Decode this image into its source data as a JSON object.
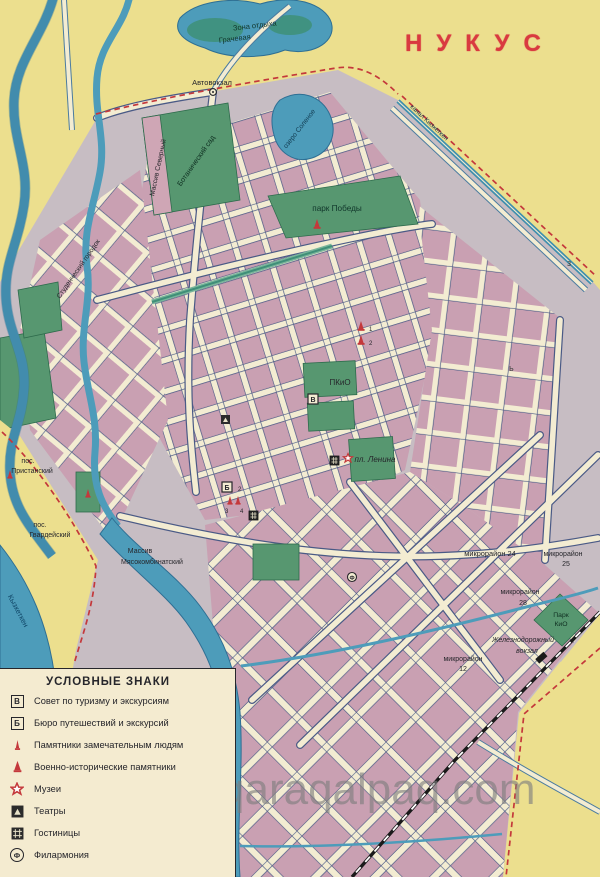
{
  "title": "НУКУС",
  "watermark": "qaraqalpaq.com",
  "colors": {
    "title_red": "#d93a40",
    "background_yellow": "#ecdf8e",
    "city_grey": "#c7bdc3",
    "block_pink": "#c9a0b2",
    "street_cream": "#f3ecd2",
    "water_blue": "#4d9cba",
    "park_green": "#579770",
    "boundary_red_dash": "#c4383b",
    "railway_black": "#1a1a1a",
    "legend_cream": "#f4ebd0",
    "watermark_grey": "#7e7e7e"
  },
  "legend": {
    "title": "УСЛОВНЫЕ ЗНАКИ",
    "items": [
      {
        "id": "tourism-council",
        "glyph": "В",
        "label": "Совет по туризму и экскурсиям"
      },
      {
        "id": "travel-bureau",
        "glyph": "Б",
        "label": "Бюро путешествий и экскурсий"
      },
      {
        "id": "monuments-people",
        "glyph": "",
        "label": "Памятники замечательным людям"
      },
      {
        "id": "war-monuments",
        "glyph": "",
        "label": "Военно-исторические памятники"
      },
      {
        "id": "museums",
        "glyph": "",
        "label": "Музеи"
      },
      {
        "id": "theatres",
        "glyph": "",
        "label": "Театры"
      },
      {
        "id": "hotels",
        "glyph": "",
        "label": "Гостиницы"
      },
      {
        "id": "philharmonic",
        "glyph": "Ф",
        "label": "Филармония"
      }
    ]
  },
  "map_labels": {
    "zona_otdyha_1": "Зона отдыха",
    "zona_otdyha_2": "Грачевая",
    "avtovokzal": "Автовокзал",
    "massiv_severny": "Массив Северный",
    "botanichesky_sad": "Ботанический сад",
    "ozero": "озеро Соленое",
    "park_pobedy": "парк Победы",
    "kanal_top": "канал Кызкеткен",
    "studgorodok": "Студенческий городок",
    "pkio": "ПКиО",
    "pl_lenina": "пл. Ленина",
    "pos_pristansky_1": "пос.",
    "pos_pristansky_2": "Пристанский",
    "pos_gvardeysky_1": "пос.",
    "pos_gvardeysky_2": "Гвардейский",
    "massiv_mk_1": "Массив",
    "massiv_mk_2": "Мясокомбинатский",
    "mkr24": "микрорайон 24",
    "mkr25_1": "микрорайон",
    "mkr25_2": "25",
    "mkr28_1": "микрорайон",
    "mkr28_2": "28",
    "park_kio_1": "Парк",
    "park_kio_2": "КиО",
    "zhd_1": "Железнодорожный",
    "zhd_2": "вокзал",
    "mkr12_1": "микрорайон",
    "mkr12_2": "12",
    "river": "Кызкеткен",
    "grid_letter_z": "з",
    "grid_letter_b": "ь",
    "num1": "1",
    "num2": "2",
    "num2b": "2",
    "num3": "3",
    "num4": "4"
  }
}
